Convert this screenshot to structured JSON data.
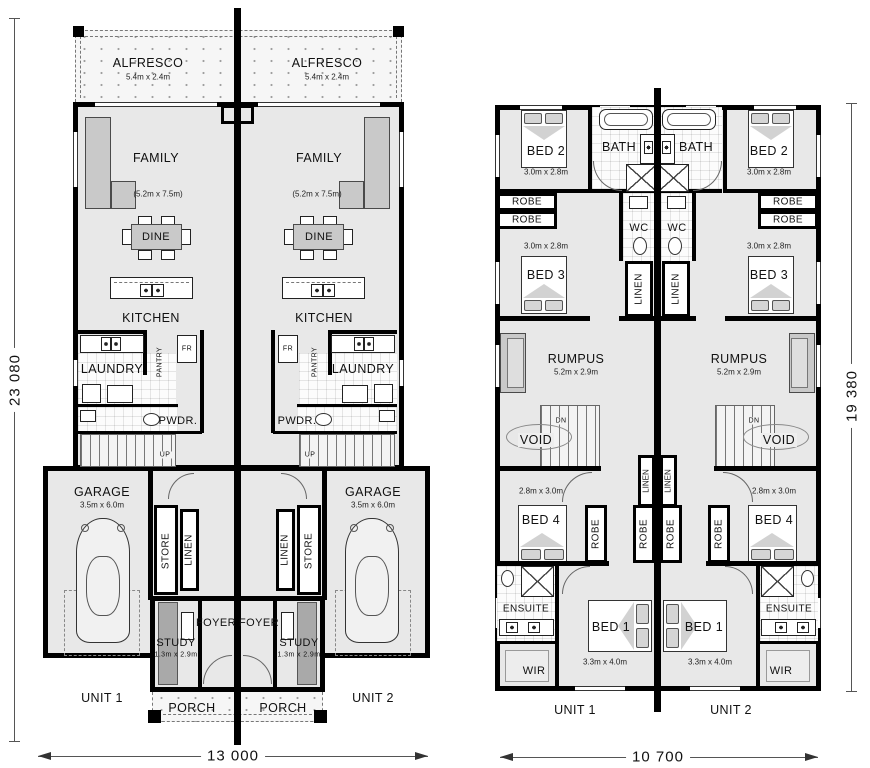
{
  "colors": {
    "wall": "#000000",
    "floor": "#e8e8e8",
    "tile": "#fbfbfb",
    "furniture": "#c9c9c9",
    "outdoor_stipple": "#f6f6f6"
  },
  "ground": {
    "alfresco": {
      "name": "ALFRESCO",
      "dim": "5.4m x 2.4m"
    },
    "family": {
      "name": "FAMILY",
      "dim": "(5.2m x 7.5m)"
    },
    "dine": "DINE",
    "kitchen": "KITCHEN",
    "laundry": "LAUNDRY",
    "pantry": "PANTRY",
    "fridge": "FR",
    "pwdr": "PWDR.",
    "up": "UP",
    "garage": {
      "name": "GARAGE",
      "dim": "3.5m x 6.0m"
    },
    "store": "STORE",
    "linen": "LINEN",
    "foyer": "FOYER",
    "study": {
      "name": "STUDY",
      "dim": "1.3m x 2.9m"
    },
    "porch": "PORCH",
    "unit1": "UNIT 1",
    "unit2": "UNIT 2",
    "width_dim": "13 000",
    "height_dim": "23 080"
  },
  "first": {
    "bed1": {
      "name": "BED 1",
      "dim": "3.3m x 4.0m"
    },
    "bed2": {
      "name": "BED 2",
      "dim": "3.0m x 2.8m"
    },
    "bed3": {
      "name": "BED 3",
      "dim": "3.0m x 2.8m"
    },
    "bed4": {
      "name": "BED 4",
      "dim": "2.8m x 3.0m"
    },
    "bath": "BATH",
    "robe": "ROBE",
    "wc": "WC",
    "linen": "LINEN",
    "rumpus": {
      "name": "RUMPUS",
      "dim": "5.2m x 2.9m"
    },
    "void": "VOID",
    "dn": "DN",
    "ensuite": "ENSUITE",
    "wir": "WIR",
    "unit1": "UNIT 1",
    "unit2": "UNIT 2",
    "width_dim": "10 700",
    "height_dim": "19 380"
  }
}
